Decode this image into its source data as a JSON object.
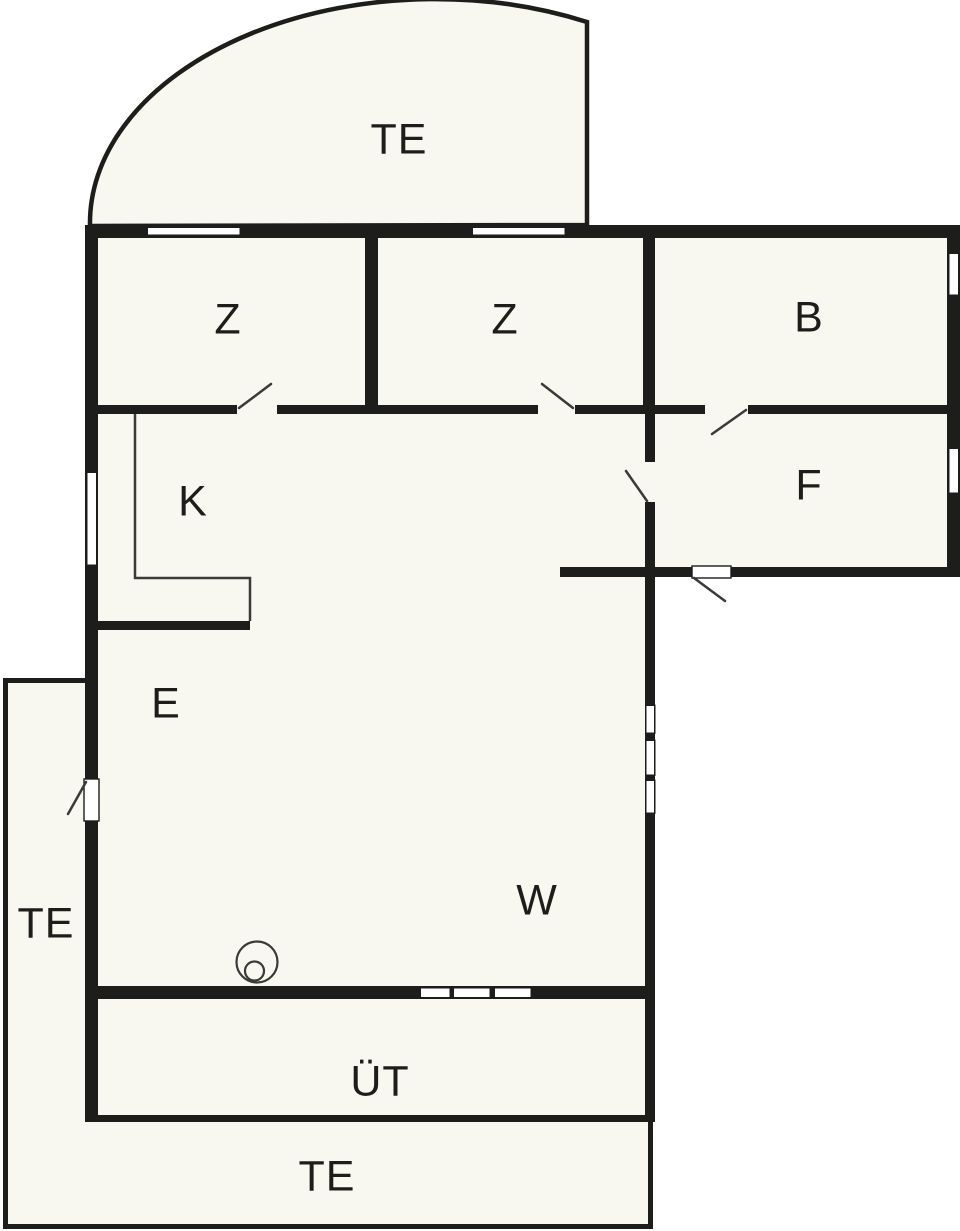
{
  "rooms": {
    "terrace_top": {
      "label": "TE"
    },
    "bedroom_1": {
      "label": "Z"
    },
    "bedroom_2": {
      "label": "Z"
    },
    "bathroom": {
      "label": "B"
    },
    "hallway": {
      "label": "F"
    },
    "kitchen": {
      "label": "K"
    },
    "entry": {
      "label": "E"
    },
    "living_room": {
      "label": "W"
    },
    "covered_terrace": {
      "label": "ÜT"
    },
    "terrace_left": {
      "label": "TE"
    },
    "terrace_bottom": {
      "label": "TE"
    }
  },
  "colors": {
    "wall": "#1d1d1b",
    "interior": "#f8f7f0",
    "exterior": "#ffffff",
    "line": "#3a3a38",
    "window": "#ffffff"
  }
}
